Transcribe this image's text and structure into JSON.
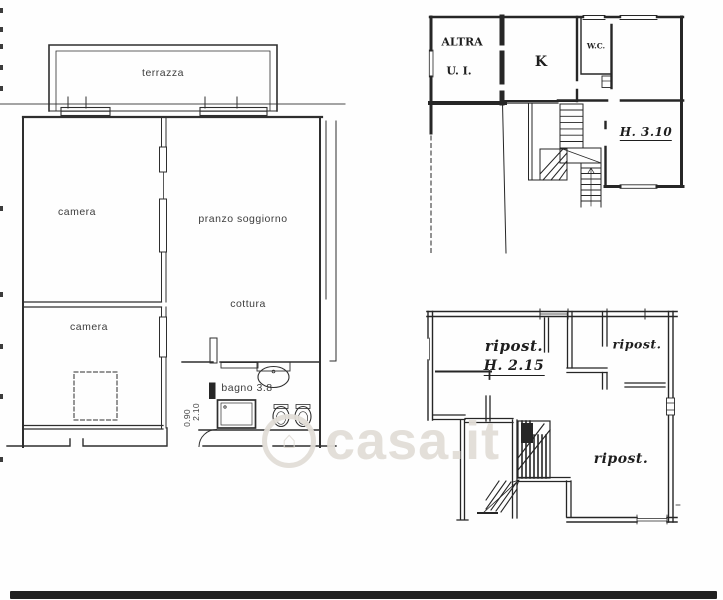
{
  "plan_main": {
    "terrace_label": "terrazza",
    "bedroom1_label": "camera",
    "living_label": "pranzo soggiorno",
    "kitchen_label": "cottura",
    "bedroom2_label": "camera",
    "bath_label": "bagno 3.8",
    "door_height": "2.10",
    "door_width": "0.90"
  },
  "plan_upper": {
    "unit_label_line1": "ALTRA",
    "unit_label_line2": "U. I.",
    "kitchen_label": "K",
    "wc_label": "W.C.",
    "height_label": "H. 3.10"
  },
  "plan_lower": {
    "storage1_label": "ripost.",
    "storage1_height": "H. 2.15",
    "storage2_label": "ripost.",
    "storage3_label": "ripost."
  },
  "watermark": {
    "text": "casa.it",
    "icon": "house-circle-icon",
    "house_glyph": "⌂"
  },
  "colors": {
    "ink": "#2e2e2e",
    "ink_dark": "#242424",
    "paper": "#fefefe",
    "watermark": "#e1ddd7",
    "scan_bar": "#212121"
  }
}
